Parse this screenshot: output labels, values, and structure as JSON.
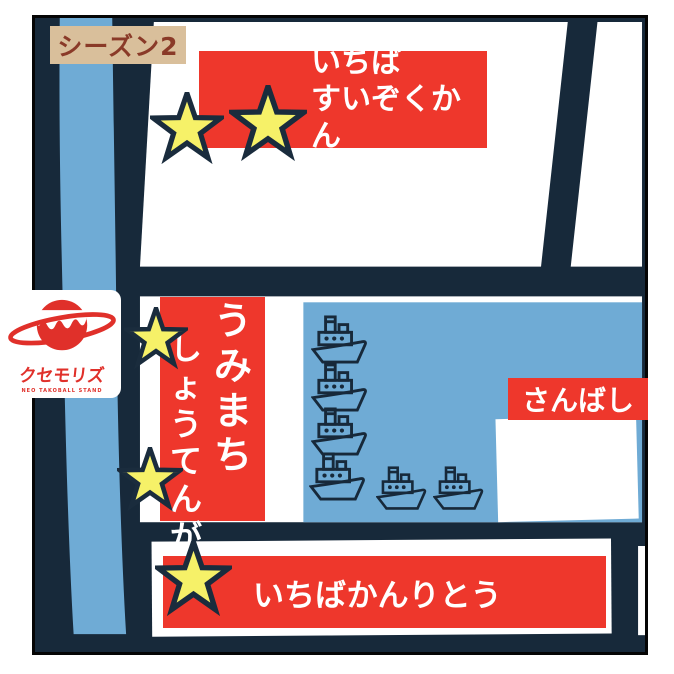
{
  "map": {
    "season_label": "シーズン2",
    "locations": {
      "aquarium": {
        "line1": "いちば",
        "line2": "すいぞくかん",
        "stars": 2
      },
      "shopping_street": {
        "line1": "うみまち",
        "line2": "しょうてんがい",
        "stars": 2
      },
      "pier": {
        "label": "さんばし",
        "stars": 0
      },
      "control_tower": {
        "label": "いちばかんりとう",
        "stars": 1
      }
    },
    "boats_count": 6,
    "total_stars": 5
  },
  "logo": {
    "name": "クセモリズ",
    "tagline": "NEO TAKOBALL STAND"
  },
  "colors": {
    "road_navy": "#17293a",
    "banner_red": "#ee372c",
    "water_blue": "#6fabd5",
    "star_yellow": "#f6f168",
    "season_tan": "#d9bf9b",
    "season_text": "#8a3a28",
    "logo_red": "#e0302a"
  }
}
